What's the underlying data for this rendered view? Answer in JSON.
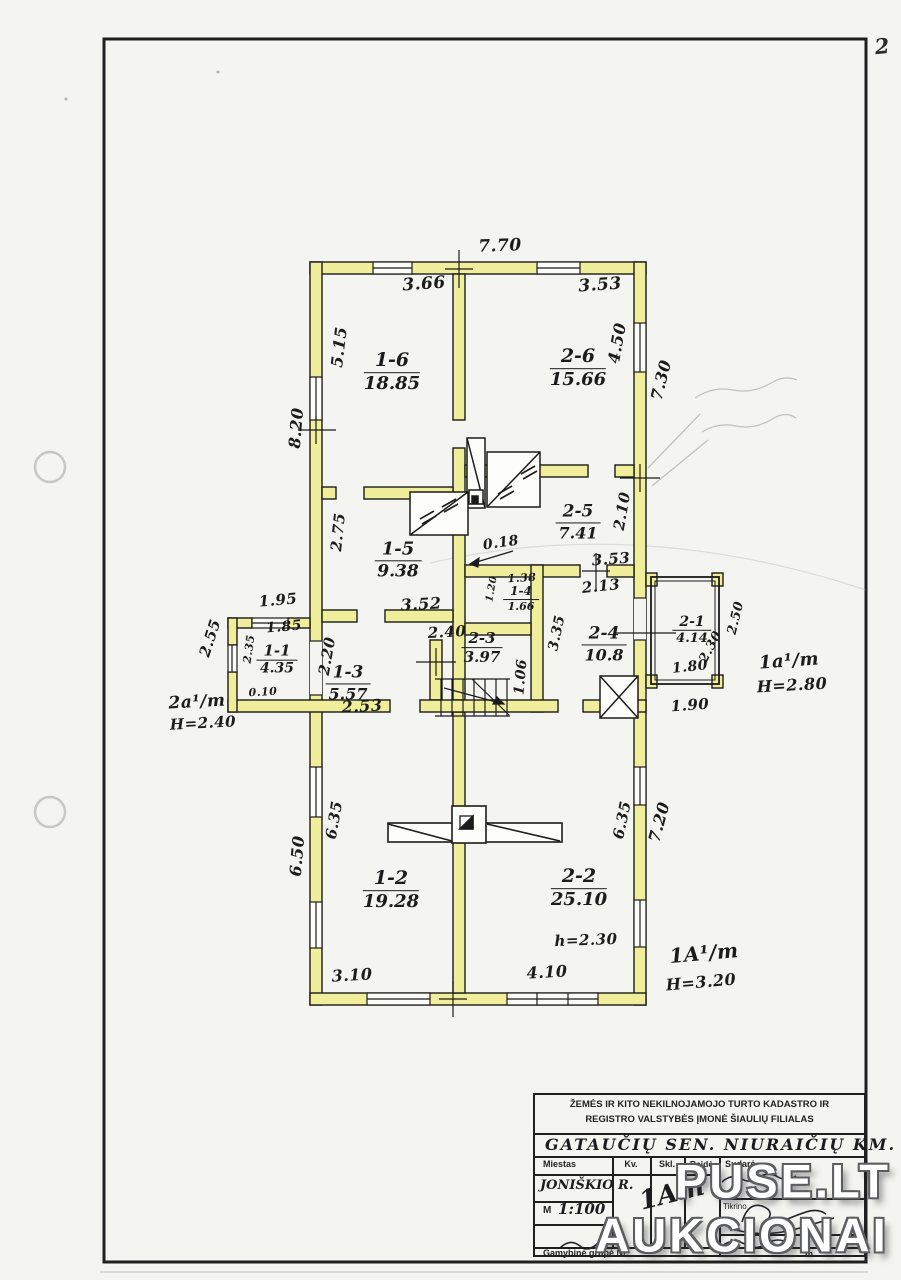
{
  "page": {
    "number": "2"
  },
  "watermark": {
    "line1": "PUSE.LT",
    "line2": "AUKCIONAI"
  },
  "colors": {
    "wall_fill": "#f1ee9b",
    "ink": "#1b1b1b",
    "watermark_text": "#ffffff",
    "watermark_outline": "#5c5d61"
  },
  "plan": {
    "rooms": [
      {
        "id": "1-6",
        "area": "18.85"
      },
      {
        "id": "2-6",
        "area": "15.66"
      },
      {
        "id": "1-5",
        "area": "9.38"
      },
      {
        "id": "2-5",
        "area": "7.41"
      },
      {
        "id": "1-4",
        "area": "1.66"
      },
      {
        "id": "2-4",
        "area": "10.8"
      },
      {
        "id": "1-3",
        "area": "5.57"
      },
      {
        "id": "2-3",
        "area": "3.97"
      },
      {
        "id": "1-1",
        "area": "4.35"
      },
      {
        "id": "2-1",
        "area": "4.14"
      },
      {
        "id": "1-2",
        "area": "19.28"
      },
      {
        "id": "2-2",
        "area": "25.10"
      }
    ],
    "dims": {
      "top_total": "7.70",
      "w16": "3.66",
      "w26": "3.53",
      "h16": "5.15",
      "left_upper": "8.20",
      "h26": "4.50",
      "right_upper": "7.30",
      "h15": "2.75",
      "h25": "2.10",
      "w15": "3.52",
      "w25": "3.53",
      "d213": "2.13",
      "d018": "0.18",
      "w14": "1.38",
      "h14": "1.20",
      "d335": "3.35",
      "d240": "2.40",
      "d106": "1.06",
      "h13": "2.20",
      "w13": "2.53",
      "top11": "1.95",
      "w11": "1.85",
      "left11": "2.55",
      "h11": "2.35",
      "d010": "0.10",
      "w21": "1.80",
      "b21": "1.90",
      "diag21": "2.30",
      "right21": "2.50",
      "left_lower": "6.50",
      "h12": "6.35",
      "h22": "6.35",
      "right_lower": "7.20",
      "w12": "3.10",
      "w22": "4.10",
      "note22": "h=2.30"
    },
    "notes": {
      "left1": "2a¹/m",
      "left2": "H=2.40",
      "right1": "1a¹/m",
      "right2": "H=2.80",
      "bottom1": "1A¹/m",
      "bottom2": "H=3.20"
    }
  },
  "title_block": {
    "org_line1": "ŽEMĖS IR KITO NEKILNOJAMOJO TURTO KADASTRO IR",
    "org_line2": "REGISTRO VALSTYBĖS ĮMONĖ ŠIAULIŲ FILIALAS",
    "location": "GATAUČIŲ SEN. NIURAIČIŲ KM.",
    "columns": {
      "miestas": "Miestas",
      "kv": "Kv.",
      "skl": "Skl.",
      "raide": "Raidė",
      "sudare": "Sudarė"
    },
    "miestas_value": "JONIŠKIO R.",
    "scale_label": "M",
    "scale_value": "1:100",
    "parcel_value": "1Am",
    "tikrino_label": "Tikrino",
    "bottom_label": "Gamybinė grupė Nr.",
    "unit_label": "m."
  }
}
